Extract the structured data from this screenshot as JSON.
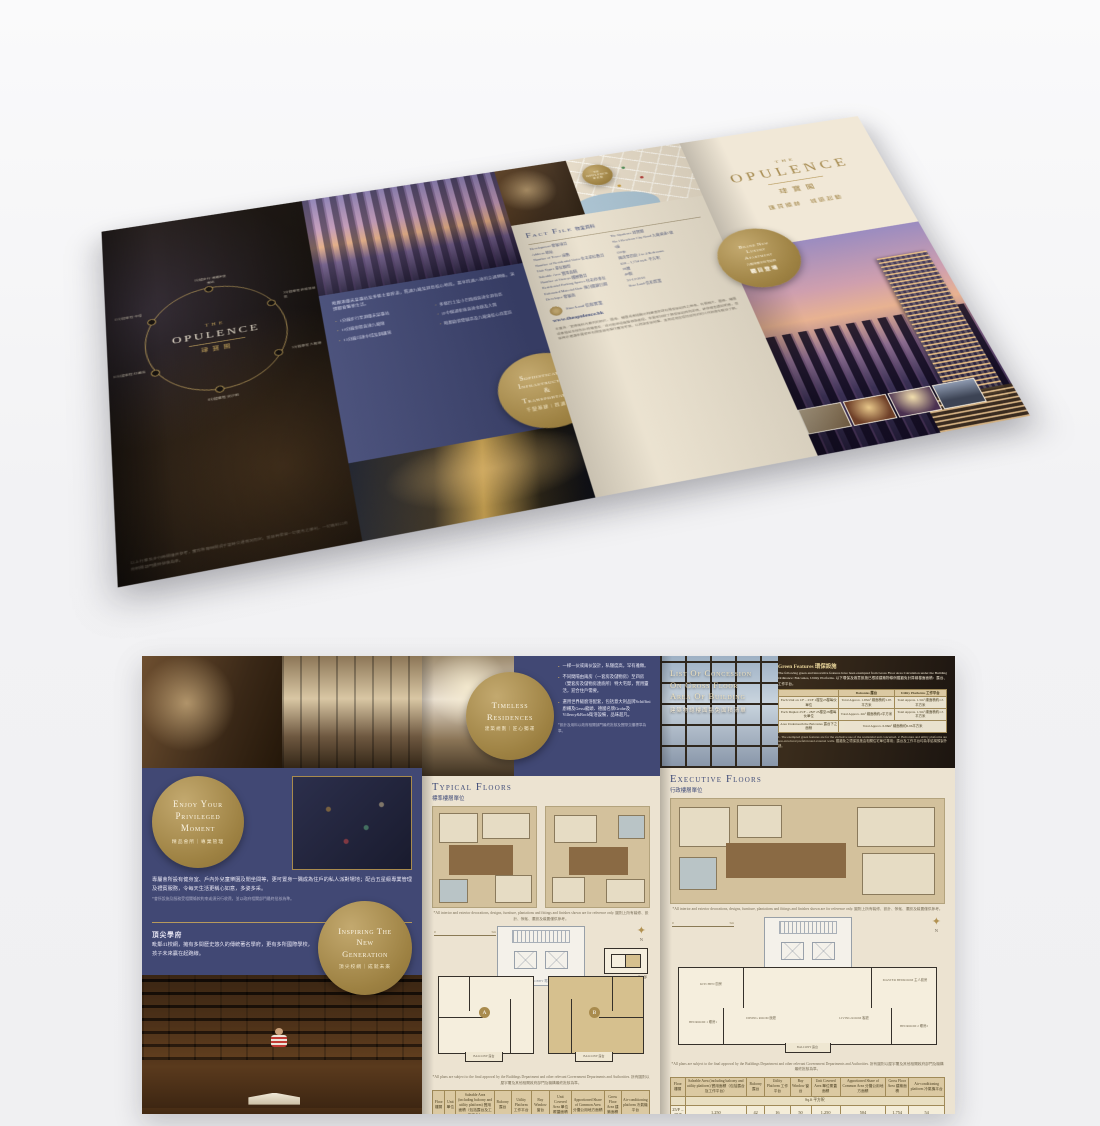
{
  "brand": {
    "the": "THE",
    "name": "OPULENCE",
    "cn": "珒寶閣",
    "tagline": "匯賢顯赫　城脈起動",
    "website": "www.theopulence.hk",
    "gold": "#a3874a",
    "navy": "#414874",
    "cream": "#ece3d1"
  },
  "top": {
    "back": {
      "spokes": [
        "1分鐘步行 港鐵宋皇臺站",
        "3分鐘車程 啟德發展區",
        "5分鐘車程 九龍塘",
        "8分鐘車程 尖沙咀",
        "10分鐘車程 紅磡站",
        "15分鐘車程 中環"
      ],
      "footnote": "以上行車及步行時間僅供參考，實際所需時間視乎當時交通情況而定。發展商保留一切更改之權利，一切資料以政府相關部門最終批核為準。"
    },
    "transport": {
      "intro": "毗鄰港鐵宋皇臺站及多條主要幹道，貫通九龍及港島核心地段，盡享四通八達的交通網絡，演繹都會繁華生活。",
      "bullets_left": [
        "1分鐘步行至港鐵宋皇臺站",
        "10分鐘車程直達九龍塘",
        "15分鐘可達中環及銅鑼灣"
      ],
      "bullets_right": [
        "多條巴士及小巴路線直達全港各區",
        "沙中線通車後直達金鐘及大圍",
        "毗鄰啟德發展區及九龍東核心商業區"
      ],
      "circle": {
        "l1": "Sophisticated",
        "l2": "Infrastructure",
        "l3": "&",
        "l4": "Transportation",
        "cn": "千變基建｜四通八達"
      }
    },
    "factfile": {
      "title_en": "Fact File",
      "title_cn": "物業資料",
      "rows": [
        {
          "label": "Development 發展項目",
          "value": "The Opulence 珒寶閣"
        },
        {
          "label": "Address 地址",
          "value": "No.1 Kowloon City Road 九龍城道1號"
        },
        {
          "label": "Number of Tower 座數",
          "value": "1座"
        },
        {
          "label": "Number of Residential Units 住宅單位數目",
          "value": "150伙"
        },
        {
          "label": "Unit Types 單位類型",
          "value": "兩房至四房 2 to 4 Bedrooms"
        },
        {
          "label": "Saleable Area 實用面積",
          "value": "658 – 1,754 sq.ft. 平方呎"
        },
        {
          "label": "Number of Storeys 樓層數目",
          "value": "28層"
        },
        {
          "label": "Residential Parking Spaces 住宅停車位",
          "value": "40個"
        },
        {
          "label": "Estimated Material Date 預計關鍵日期",
          "value": "31-12-2018"
        },
        {
          "label": "Developer 發展商",
          "value": "Sino Land 信和置業"
        }
      ],
      "developer": "Sino Land 信和置業",
      "disclaimer": "本廣告／宣傳資料內載列的相片、圖像、繪圖或素描顯示純屬畫家對有關發展項目之想像。有關相片、圖像、繪圖或素描並非按照比例繪畫及／或可能經過電腦修飾處理。準買家如欲了解發展項目的詳情，請參閱售樓說明書。發展商亦建議準買家到有關發展地盤作實地考察，以對該發展地盤、其周邊地區環境及附近的公共設施有較佳了解。"
    },
    "map": {
      "note": "地圖僅供參考，並非按照比例繪畫。"
    },
    "cover": {
      "badge": {
        "l1": "Brand New",
        "l2": "Luxury",
        "l3": "Apartment",
        "sub": "九龍城臻罕住宅項目",
        "cta": "矚目登場"
      }
    }
  },
  "bottom": {
    "club": {
      "circle": {
        "l1": "Enjoy Your",
        "l2": "Privileged",
        "l3": "Moment",
        "cn": "精品會所｜專業管理"
      },
      "para": "專屬會所設有健身室、戶內外兒童樂園及閒坐間等，更可置身一隅成為住戶的私人派對場地；配合五星級專業管理及禮賓服務，令每天生活更稱心如意，多姿多采。",
      "footnote": "*會所設施及服務受相關條款約束或須另行收費，並以政府相關部門最終批核為準。",
      "schools_title": "頂尖學府",
      "schools_para": "毗鄰41校網，擁有多間歷史悠久的傳統著名學府，更有多所國際學校，孩子未來贏在起跑線。",
      "circle2": {
        "l1": "Inspiring The",
        "l2": "New",
        "l3": "Generation",
        "cn": "頂尖校網｜成就未來"
      }
    },
    "timeless": {
      "circle": {
        "l1": "Timeless",
        "l2": "Residences",
        "cn": "建築規劃｜匠心獨運"
      },
      "bullets": [
        "一梯一伙或兩伙設計，私隱度高，罕有雅緻。",
        "不同間隔由兩房（一套房及儲物房）至四房（雙套房及儲物房連廁所）特大宅邸，實用靈活，迎合住戶需要。",
        "選用世界級廚浴配套，包括意大利品牌Schiffini廚櫃及Gessi龍頭、德國名牌Grohe及Villeroy&Boch衛浴設備，品味超凡。"
      ],
      "footnote": "*設計及用料以政府相關部門最終批核及實際交樓標準為準。"
    },
    "concession": {
      "title1": "List Of Concession",
      "title2": "On Gross Floor",
      "title3": "Area Of Building",
      "title_cn": "建築物總樓面豁免面積清單",
      "green_title": "Green Features 環保設施",
      "intro": "The following green and innovative features have been exempted from Gross Floor Area Calculation under the Building Ordinance: Balconies, Utility Platforms. 以下環保及適意設施已根據建築物條例獲豁免計算總樓面面積：露台、工作平台。",
      "col1": "Balconies 露台",
      "col2": "Utility Platforms 工作平台",
      "rows": [
        {
          "label": "Each Unit on 1/F – 23/F 1樓至23樓每伙單位",
          "b": "Total Approx. 1.95m² 總面積約1.95平方米",
          "u": "Total Approx. 1.5m² 總面積約1.5平方米"
        },
        {
          "label": "Each Duplex 25/F – 28/F 25樓至28樓每伙單位",
          "b": "Total Approx. 2m² 總面積約2平方米",
          "u": "Total Approx. 1.5m² 總面積約1.5平方米"
        },
        {
          "label": "Area Underneath the Balconies 露台下之面積",
          "span": "Total Approx. 6.96m² 總面積約6.96平方米"
        }
      ],
      "notes": "1. The exempted green features are for the exclusive use of the residential unit concerned. 2. Balconies and utility platforms are non-structural prefabricated external walls. 獲豁免之環保設施由相關住宅單位專用；露台及工作平台均為非結構預製外牆。"
    },
    "typical": {
      "title": "Typical Floors",
      "cn": "標準樓層單位"
    },
    "executive": {
      "title": "Executive Floors",
      "cn": "行政樓層單位"
    },
    "plan_labels": {
      "lift_lobby": "LIFT LOBBY 電梯大堂",
      "balcony": "BALCONY 露台",
      "unit_a": "A",
      "unit_b": "B",
      "north": "N",
      "scale0": "0",
      "scale5": "5m",
      "inset": "BALCONY PART PLAN 露台部分圖則",
      "dining": "DINING ROOM 飯廳",
      "living": "LIVING ROOM 客廳",
      "master": "MASTER BEDROOM 主人套房",
      "bed1": "BEDROOM 1 睡房1",
      "bed2": "BEDROOM 2 睡房2",
      "kitchen": "KITCHEN 廚房"
    },
    "notes": {
      "render": "*All interior and exterior decorations, designs, furniture, plantations and fittings and finishes shown are for reference only. 圖則上所有裝修、設計、傢俬、擺設及裝置僅供參考。",
      "approval": "*All plans are subject to the final approval by the Buildings Department and other relevant Government Departments and Authorities. 所有圖則以屋宇署及其他相關政府部門及機構最終批核為準。"
    },
    "table_left": {
      "headers": [
        "Floor 樓層",
        "Unit 單位",
        "Saleable Area (including balcony and utility platform) 實用面積（包括露台及工作平台）",
        "Balcony 露台",
        "Utility Platform 工作平台",
        "Bay Window 窗台",
        "Unit Covered Area 單位覆蓋面積",
        "Apportioned Share of Common Area 分攤公用地方面積",
        "Gross Floor Area 建築面積",
        "Air-conditioning platform 冷氣機平台"
      ],
      "unit_label": "Sq.ft 平方呎",
      "rows": [
        [
          "5/F – 23/F",
          "A",
          "658",
          "21",
          "16",
          "10",
          "658",
          "212",
          "880",
          "12"
        ],
        [
          "",
          "B",
          "658",
          "21",
          "16",
          "10",
          "658",
          "212",
          "880",
          "12"
        ]
      ]
    },
    "table_right": {
      "headers": [
        "Floor 樓層",
        "Saleable Area (including balcony and utility platform) 實用面積（包括露台及工作平台）",
        "Balcony 露台",
        "Utility Platform 工作平台",
        "Bay Window 窗台",
        "Unit Covered Area 單位覆蓋面積",
        "Apportioned Share of Common Area 分攤公用地方面積",
        "Gross Floor Area 建築面積",
        "Air-conditioning platform 冷氣機平台"
      ],
      "unit_label": "Sq.ft 平方呎",
      "rows": [
        [
          "25/F – 28/F",
          "1,250",
          "42",
          "16",
          "50",
          "1,250",
          "504",
          "1,754",
          "54"
        ]
      ]
    }
  }
}
